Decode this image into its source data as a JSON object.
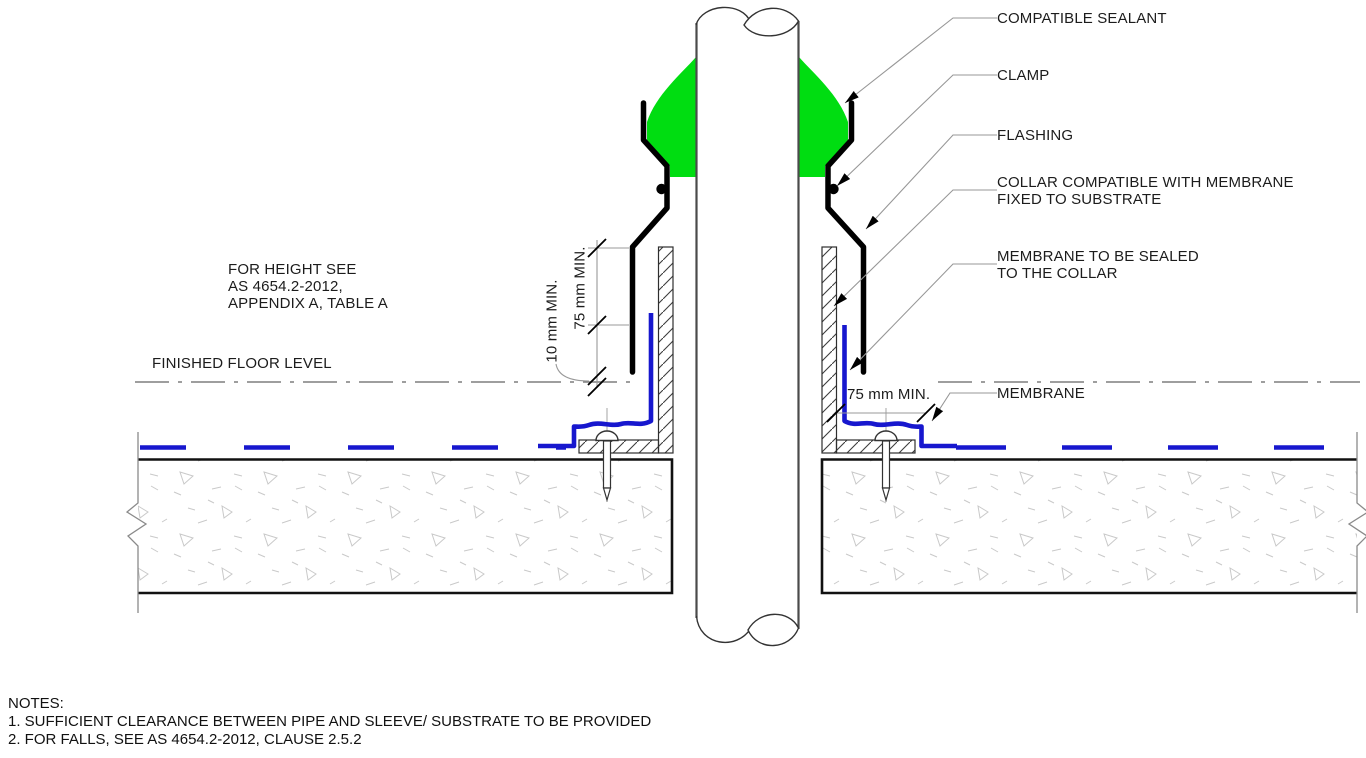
{
  "callouts": [
    {
      "label": "COMPATIBLE SEALANT"
    },
    {
      "label": "CLAMP"
    },
    {
      "label": "FLASHING"
    },
    {
      "label": "COLLAR COMPATIBLE WITH MEMBRANE\nFIXED TO SUBSTRATE"
    },
    {
      "label": "MEMBRANE TO BE SEALED\nTO THE COLLAR"
    },
    {
      "label": "MEMBRANE"
    }
  ],
  "annotations": {
    "height_reference": "FOR HEIGHT SEE\nAS 4654.2-2012,\nAPPENDIX A, TABLE A",
    "finished_floor_level": "FINISHED FLOOR LEVEL",
    "dim_collar_height": "75 mm MIN.",
    "dim_collar_clearance": "10 mm MIN.",
    "dim_membrane_lap": "75 mm MIN."
  },
  "notes": {
    "heading": "NOTES:",
    "items": [
      "1. SUFFICIENT CLEARANCE BETWEEN PIPE AND SLEEVE/ SUBSTRATE TO BE PROVIDED",
      "2. FOR FALLS, SEE AS 4654.2-2012, CLAUSE 2.5.2"
    ]
  },
  "colors": {
    "sealant_green": "#00DD11",
    "membrane_blue": "#1717CE",
    "outline_black": "#000000",
    "pipe_gray": "#4b4b4b",
    "leader_gray": "#979797",
    "centerline_gray": "#7f7f7f",
    "concrete_texture": "#c9c9c9"
  }
}
